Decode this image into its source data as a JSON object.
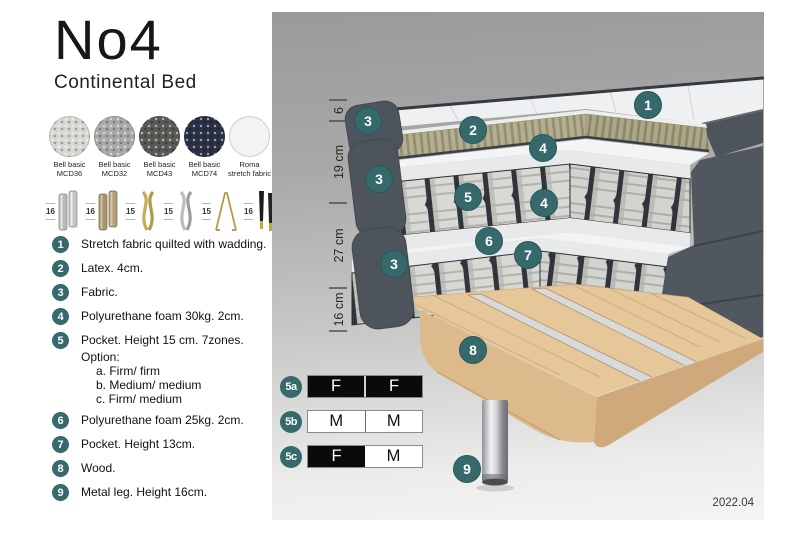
{
  "header": {
    "title": "No4",
    "subtitle": "Continental Bed"
  },
  "swatches": {
    "items": [
      {
        "line1": "Bell basic",
        "line2": "MCD36",
        "color": "#d9d7d2"
      },
      {
        "line1": "Bell basic",
        "line2": "MCD32",
        "color": "#a9a9a7"
      },
      {
        "line1": "Bell basic",
        "line2": "MCD43",
        "color": "#595956"
      },
      {
        "line1": "Bell basic",
        "line2": "MCD74",
        "color": "#2c3046"
      },
      {
        "line1": "Roma",
        "line2": "stretch fabric",
        "color": "#f3f3f3"
      }
    ]
  },
  "legs": {
    "items": [
      {
        "height": "16",
        "type": "cylinder-silver"
      },
      {
        "height": "16",
        "type": "cylinder-brass"
      },
      {
        "height": "15",
        "type": "twisted-gold"
      },
      {
        "height": "15",
        "type": "twisted-silver"
      },
      {
        "height": "15",
        "type": "hairpin-gold"
      },
      {
        "height": "16",
        "type": "tapered-black-gold"
      }
    ]
  },
  "list": {
    "items": [
      {
        "num": "1",
        "text": "Stretch fabric quilted with wadding."
      },
      {
        "num": "2",
        "text": "Latex. 4cm."
      },
      {
        "num": "3",
        "text": "Fabric."
      },
      {
        "num": "4",
        "text": "Polyurethane foam 30kg. 2cm."
      },
      {
        "num": "5",
        "text": "Pocket. Height 15 cm. 7zones. Option:",
        "options": [
          "a. Firm/ firm",
          "b. Medium/ medium",
          "c. Firm/ medium"
        ]
      },
      {
        "num": "6",
        "text": "Polyurethane foam 25kg. 2cm."
      },
      {
        "num": "7",
        "text": "Pocket. Height 13cm."
      },
      {
        "num": "8",
        "text": "Wood."
      },
      {
        "num": "9",
        "text": "Metal leg. Height 16cm."
      }
    ]
  },
  "diagram": {
    "dimensions": [
      "6",
      "19 cm",
      "27 cm",
      "16 cm"
    ],
    "callouts": {
      "c1": "1",
      "c2": "2",
      "c3": "3",
      "c4": "4",
      "c5": "5",
      "c6": "6",
      "c7": "7",
      "c8": "8",
      "c9": "9"
    },
    "firmness": {
      "rows": [
        {
          "label": "5a",
          "left": "F",
          "right": "F"
        },
        {
          "label": "5b",
          "left": "M",
          "right": "M"
        },
        {
          "label": "5c",
          "left": "F",
          "right": "M"
        }
      ]
    },
    "version": "2022.04"
  },
  "colors": {
    "accent_teal": "#35696b"
  }
}
